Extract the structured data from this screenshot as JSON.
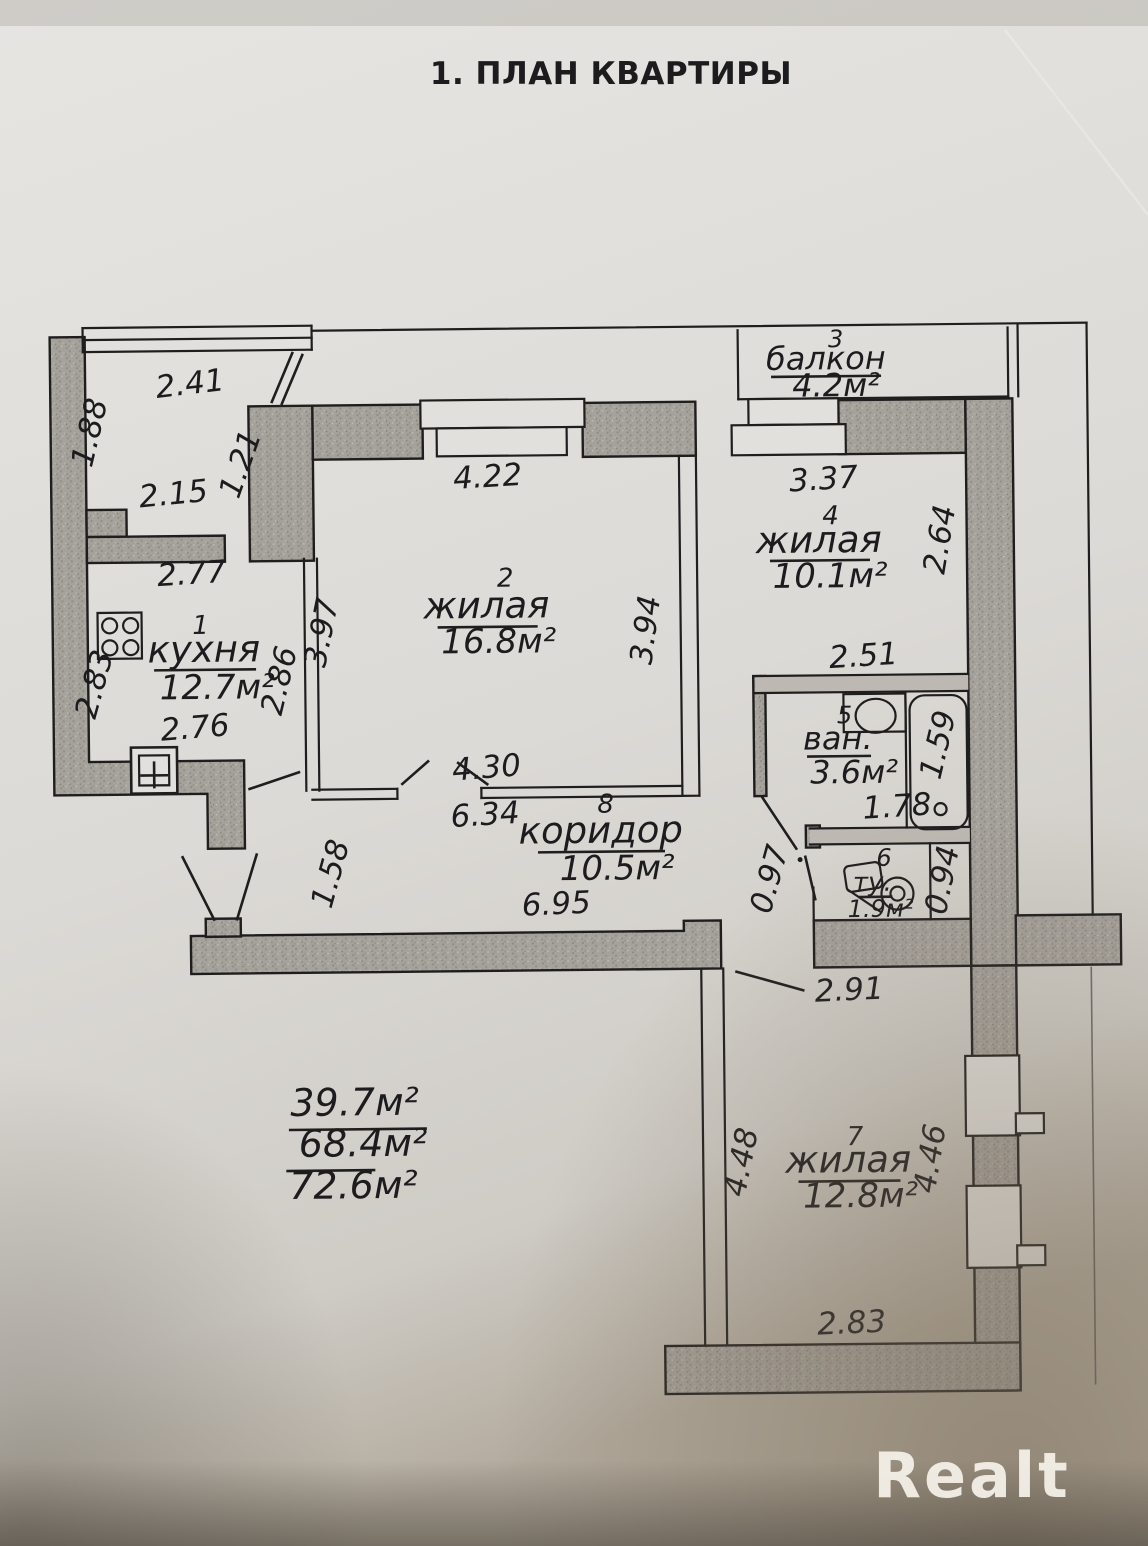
{
  "title": "1. ПЛАН КВАРТИРЫ",
  "watermark": "Realt",
  "colors": {
    "paper": "#dedbd6",
    "ink": "#1e1e1e",
    "wall_fill": "#a5a19b",
    "watermark_color": "#f6f3ec"
  },
  "rooms": [
    {
      "num": "1",
      "name": "кухня",
      "area": "12.7м²"
    },
    {
      "num": "2",
      "name": "жилая",
      "area": "16.8м²"
    },
    {
      "num": "3",
      "name": "балкон",
      "area": "4.2м²"
    },
    {
      "num": "4",
      "name": "жилая",
      "area": "10.1м²"
    },
    {
      "num": "5",
      "name": "ван.",
      "area": "3.6м²"
    },
    {
      "num": "6",
      "name": "ту.",
      "area": "1.9м²"
    },
    {
      "num": "7",
      "name": "жилая",
      "area": "12.8м²"
    },
    {
      "num": "8",
      "name": "коридор",
      "area": "10.5м²"
    }
  ],
  "totals": [
    "39.7м²",
    "68.4м²",
    "72.6м²"
  ],
  "dimensions": [
    {
      "label": "2.41"
    },
    {
      "label": "1.88"
    },
    {
      "label": "2.15"
    },
    {
      "label": "1.21"
    },
    {
      "label": "4.22"
    },
    {
      "label": "3.37"
    },
    {
      "label": "2.64"
    },
    {
      "label": "2.51"
    },
    {
      "label": "2.77"
    },
    {
      "label": "3.97"
    },
    {
      "label": "3.94"
    },
    {
      "label": "2.86"
    },
    {
      "label": "2.83"
    },
    {
      "label": "2.76"
    },
    {
      "label": "1.59"
    },
    {
      "label": "1.78"
    },
    {
      "label": "4.30"
    },
    {
      "label": "6.34"
    },
    {
      "label": "0.97"
    },
    {
      "label": "0.94"
    },
    {
      "label": "1.58"
    },
    {
      "label": "6.95"
    },
    {
      "label": "2.91"
    },
    {
      "label": "4.48"
    },
    {
      "label": "4.46"
    },
    {
      "label": "2.83"
    }
  ]
}
